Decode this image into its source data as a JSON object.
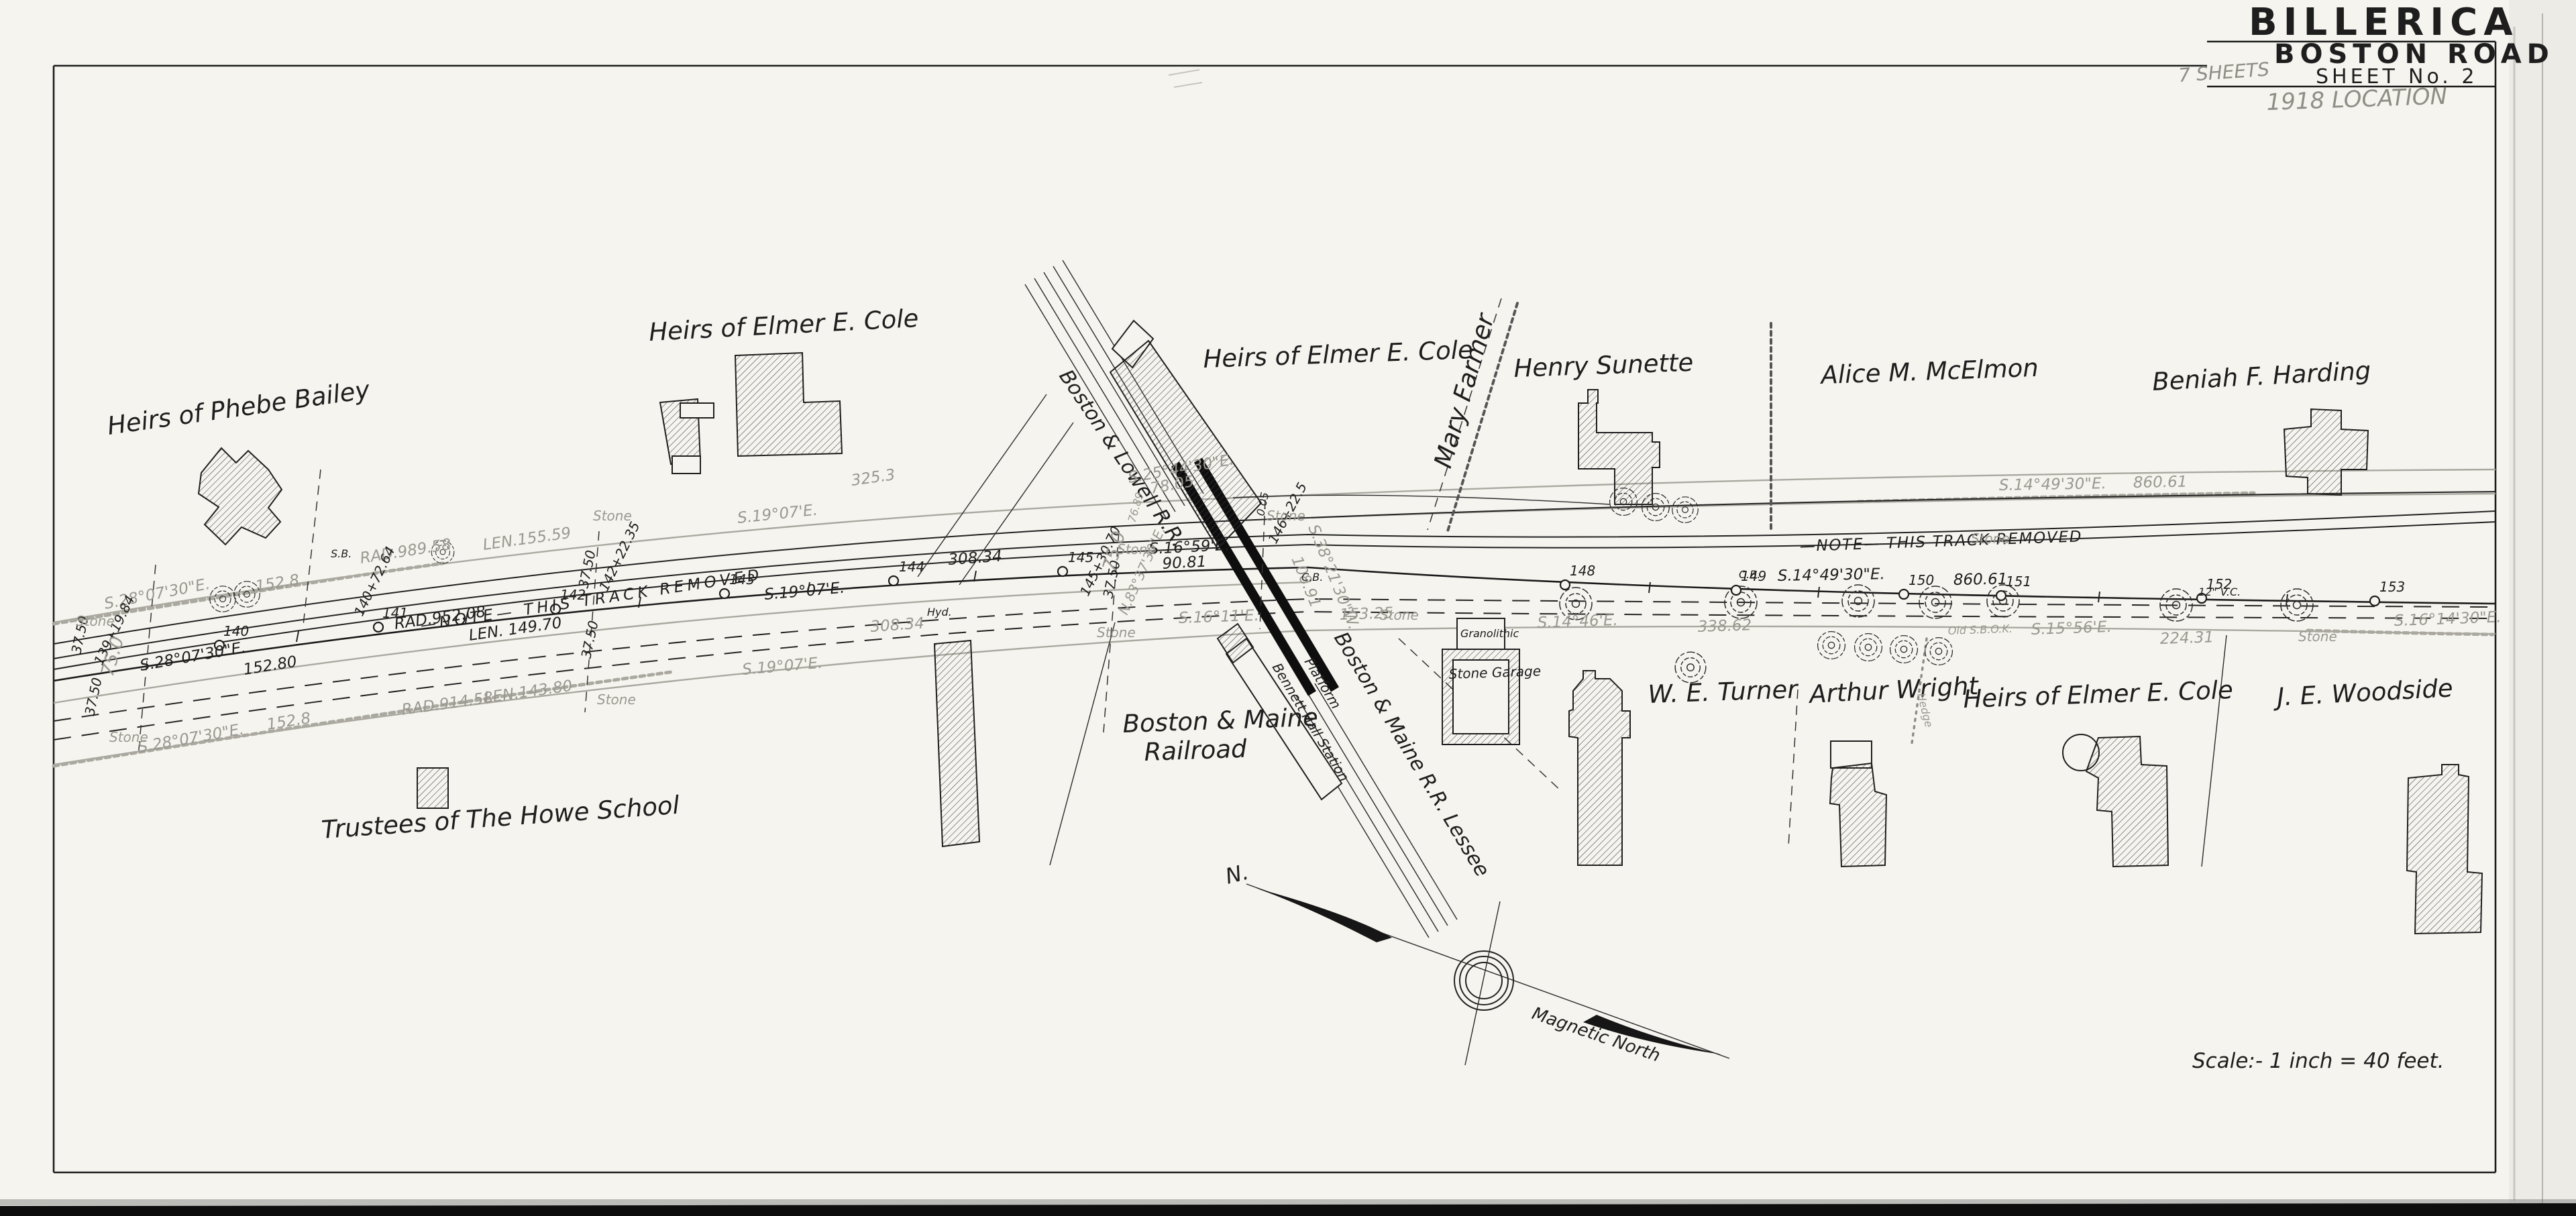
{
  "title_block": {
    "town": "BILLERICA",
    "road": "BOSTON ROAD",
    "sheet_word": "SHEET",
    "sheet_no": "No. 2",
    "pencil_sheets": "7 SHEETS",
    "pencil_location": "1918 LOCATION"
  },
  "scale_note": "Scale:- 1 inch = 40 feet.",
  "compass": {
    "north": "N.",
    "magnetic": "Magnetic North"
  },
  "owners": {
    "phebe_bailey": "Heirs of Phebe Bailey",
    "elmer_cole": "Heirs of Elmer E. Cole",
    "henry_sunette": "Henry Sunette",
    "alice_mcelmon": "Alice M. McElmon",
    "beniah_harding": "Beniah F. Harding",
    "we_turner": "W. E. Turner",
    "arthur_wright": "Arthur Wright",
    "je_woodside": "J. E. Woodside",
    "trustees_howe": "Trustees of The Howe School",
    "mary_farmer": "Mary Farmer"
  },
  "railroad": {
    "boston_lowell": "Boston & Lowell R.R.",
    "bm_line1": "Boston & Maine",
    "bm_line2": "Railroad",
    "bm_lessee": "Boston & Maine R.R. Lessee",
    "station": "Bennett Hall Station",
    "platform": "Platform"
  },
  "buildings": {
    "stone_garage": "Stone Garage",
    "granolithic": "Granolithic"
  },
  "notes": {
    "track_removed": "—NOTE—  THIS  TRACK  REMOVED"
  },
  "markers": {
    "stone": "Stone",
    "hyd": "Hyd.",
    "cb": "C.B.",
    "sb": "S.B.",
    "hedge": "Hedge",
    "old_sb": "Old S.B.O.K.",
    "vc": "12\" V.C."
  },
  "survey": {
    "s28": "S.28°07'30\"E.",
    "v152_8": "152.8",
    "v152_80": "152.80",
    "rad989": "RAD.989.58",
    "len155": "LEN.155.59",
    "rad952": "RAD.952.08",
    "len149": "LEN. 149.70",
    "rad914": "RAD.914.58",
    "len143": "LEN.143.80",
    "s19": "S.19°07'E.",
    "v308": "308.34",
    "v325": "325.3",
    "s16_59": "S.16°59'E.",
    "v90": "90.81",
    "s16_11": "S.16°11'E.",
    "v153_25": "153.25",
    "s25": "S.25°44'30\"E.",
    "v78": "78.05",
    "s38": "S.38°21'30\"W.",
    "v108": "108.91",
    "v76": "76.89",
    "s14_49": "S.14°49'30\"E.",
    "v860": "860.61",
    "s14_46": "S.14°46'E.",
    "v338": "338.62",
    "s15_56": "S.15°56'E.",
    "v224": "224.31",
    "s16_14": "S.16°14'30\"E.",
    "v37": "37.50",
    "v75": "75.0",
    "v0": "0.05",
    "n83": "N.83°37'30\"E.",
    "st139": "139+19.84",
    "st140": "140+72.64",
    "st142": "142+22.35",
    "st145": "145+30.70",
    "st146": "146+22.5"
  },
  "stations": {
    "s140": "140",
    "s141": "141",
    "s142": "142",
    "s143": "143",
    "s144": "144",
    "s145": "145",
    "s148": "148",
    "s149": "149",
    "s150": "150",
    "s151": "151",
    "s152": "152",
    "s153": "153"
  }
}
